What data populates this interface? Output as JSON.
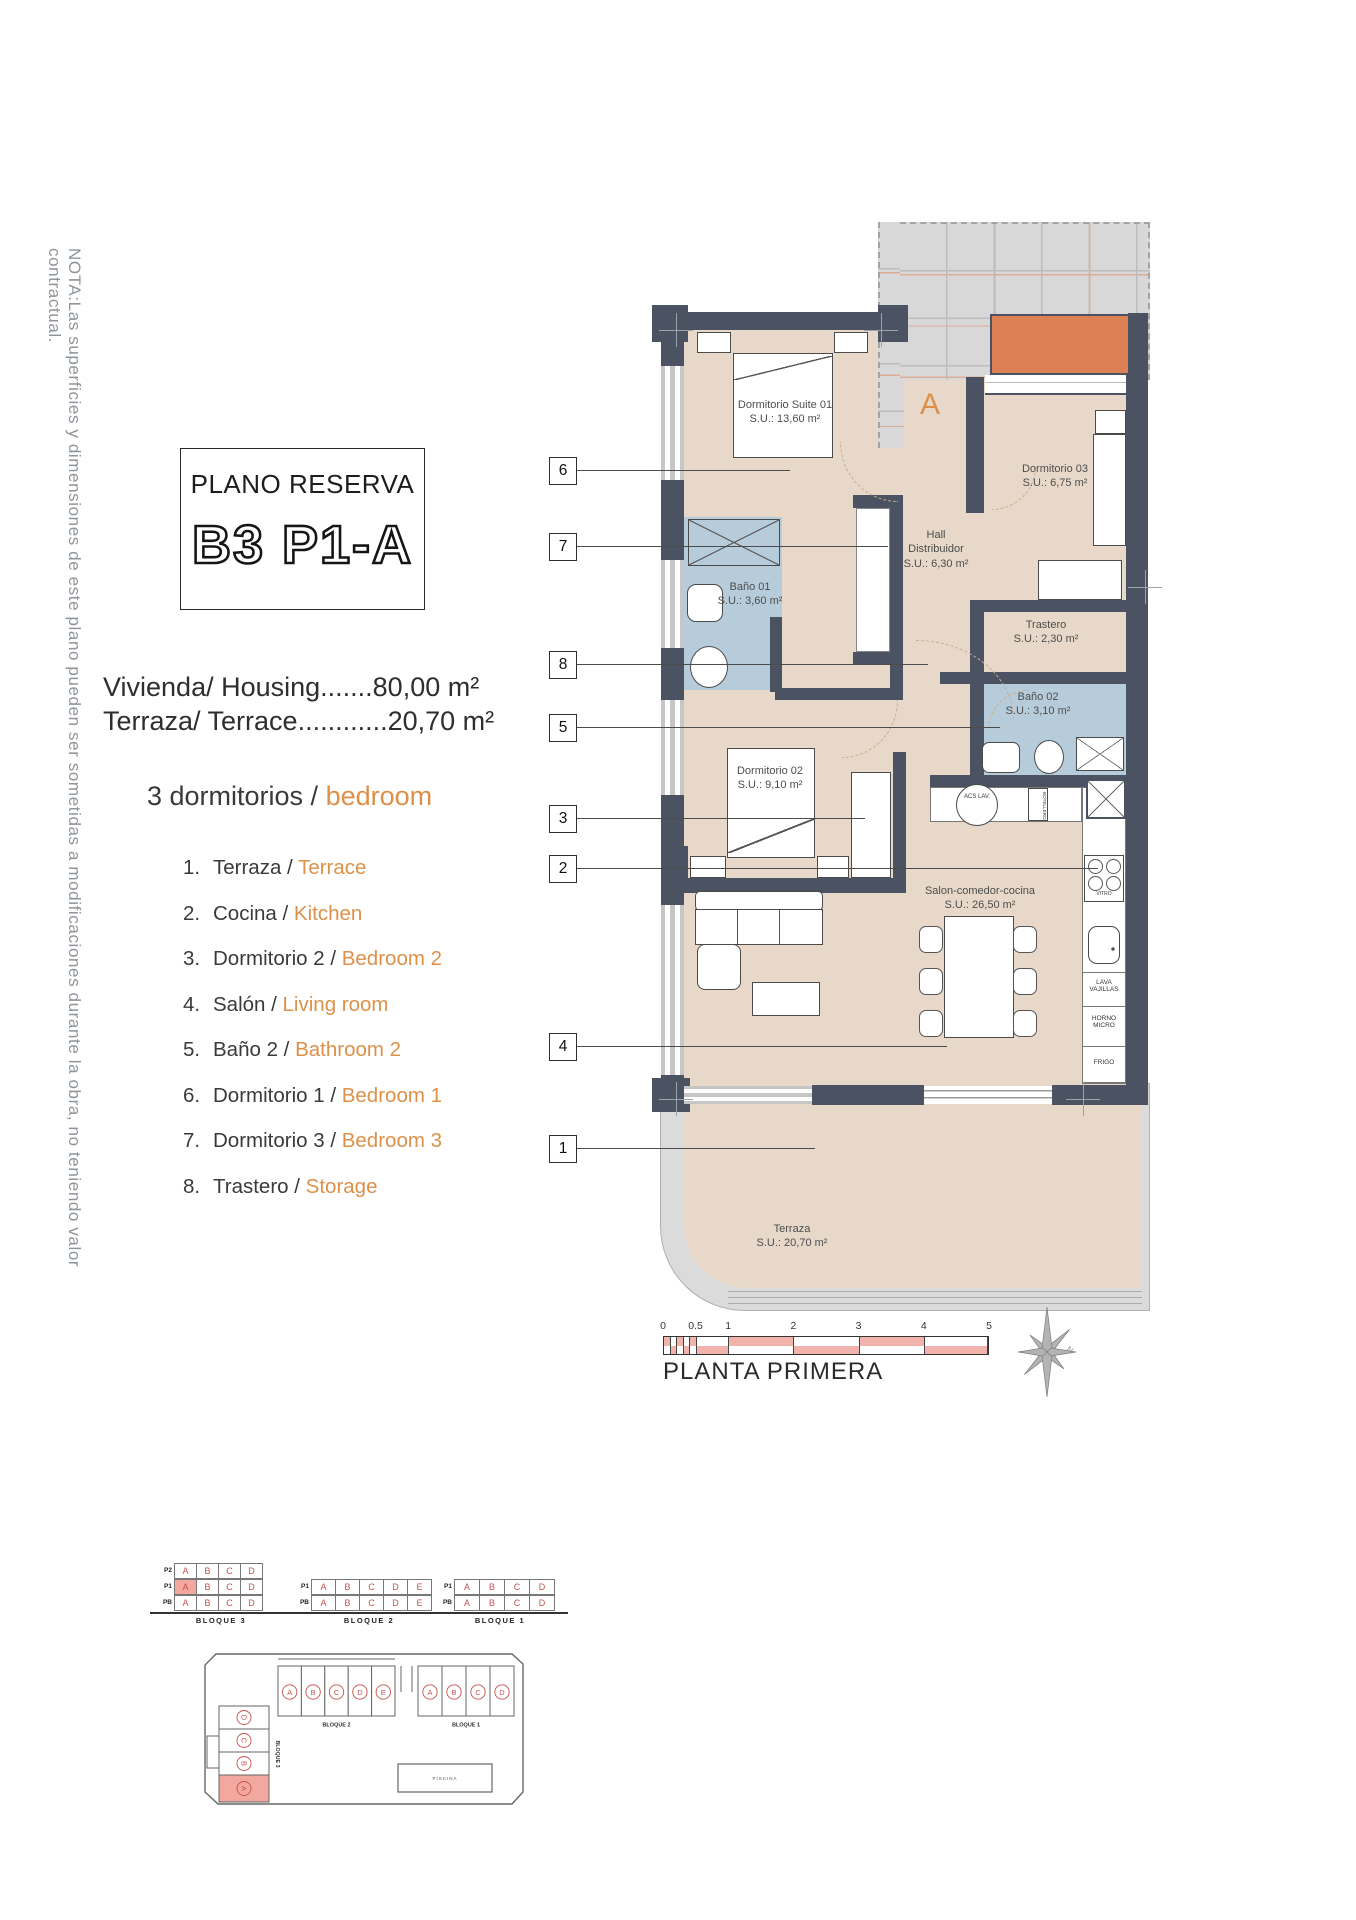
{
  "note": "NOTA:Las superficies y dimensiones de este plano pueden ser sometidas a modificaciones durante la obra, no teniendo valor contractual.",
  "title_box": {
    "kicker": "PLANO RESERVA",
    "code": "B3 P1-A"
  },
  "summary": {
    "housing": "Vivienda/ Housing.......80,00 m²",
    "terrace": "Terraza/ Terrace............20,70 m²",
    "bedrooms_es": "3 dormitorios /",
    "bedrooms_en": "bedroom"
  },
  "legend": [
    {
      "num": "1.",
      "es": "Terraza /",
      "en": "Terrace"
    },
    {
      "num": "2.",
      "es": "Cocina /",
      "en": "Kitchen"
    },
    {
      "num": "3.",
      "es": "Dormitorio 2 /",
      "en": "Bedroom 2"
    },
    {
      "num": "4.",
      "es": "Salón /",
      "en": "Living room"
    },
    {
      "num": "5.",
      "es": "Baño 2 /",
      "en": "Bathroom 2"
    },
    {
      "num": "6.",
      "es": "Dormitorio 1 /",
      "en": "Bedroom 1"
    },
    {
      "num": "7.",
      "es": "Dormitorio 3 /",
      "en": "Bedroom 3"
    },
    {
      "num": "8.",
      "es": "Trastero /",
      "en": "Storage"
    }
  ],
  "plan": {
    "unit_letter": "A",
    "rooms": {
      "suite": {
        "name": "Dormitorio Suite 01",
        "area": "S.U.: 13,60 m²"
      },
      "dorm03": {
        "name": "Dormitorio 03",
        "area": "S.U.: 6,75 m²"
      },
      "hall": {
        "name": "Hall Distribuidor",
        "area": "S.U.: 6,30 m²"
      },
      "bano01": {
        "name": "Baño 01",
        "area": "S.U.: 3,60 m²"
      },
      "trastero": {
        "name": "Trastero",
        "area": "S.U.: 2,30 m²"
      },
      "bano02": {
        "name": "Baño 02",
        "area": "S.U.: 3,10 m²"
      },
      "dorm02": {
        "name": "Dormitorio 02",
        "area": "S.U.: 9,10 m²"
      },
      "salon": {
        "name": "Salon-comedor-cocina",
        "area": "S.U.: 26,50 m²"
      },
      "terraza": {
        "name": "Terraza",
        "area": "S.U.: 20,70 m²"
      }
    },
    "callouts": [
      "6",
      "7",
      "8",
      "5",
      "3",
      "2",
      "4",
      "1"
    ],
    "kitchen": {
      "acs": "ACS LAV.",
      "botellero": "BOTELLERO",
      "vitro": "VITRO",
      "lavavajillas": "LAVA VAJILLAS",
      "horno": "HORNO MICRO",
      "frigo": "FRIGO"
    }
  },
  "scalebar": {
    "ticks": [
      "0",
      "0.5",
      "1",
      "2",
      "3",
      "4",
      "5"
    ],
    "caption": "PLANTA PRIMERA"
  },
  "blocks": {
    "b3": {
      "label": "BLOQUE 3",
      "floors": [
        "P2",
        "P1",
        "PB"
      ],
      "rows": [
        [
          "A",
          "B",
          "C",
          "D"
        ],
        [
          "A",
          "B",
          "C",
          "D"
        ],
        [
          "A",
          "B",
          "C",
          "D"
        ]
      ]
    },
    "b2": {
      "label": "BLOQUE 2",
      "floors": [
        "P1",
        "PB"
      ],
      "rows": [
        [
          "A",
          "B",
          "C",
          "D",
          "E"
        ],
        [
          "A",
          "B",
          "C",
          "D",
          "E"
        ]
      ]
    },
    "b1": {
      "label": "BLOQUE 1",
      "floors": [
        "P1",
        "PB"
      ],
      "rows": [
        [
          "A",
          "B",
          "C",
          "D"
        ],
        [
          "A",
          "B",
          "C",
          "D"
        ]
      ]
    }
  },
  "siteplan": {
    "b3_label": "BLOQUE 3",
    "b3_units": [
      "D",
      "C",
      "B",
      "A"
    ],
    "b2_label": "BLOQUE 2",
    "b2_units": [
      "A",
      "B",
      "C",
      "D",
      "E"
    ],
    "b1_label": "BLOQUE 1",
    "b1_units": [
      "A",
      "B",
      "C",
      "D"
    ],
    "piscina": "PISCINA"
  },
  "colors": {
    "accent_orange": "#DD9048",
    "wall": "#4B5363",
    "floor_beige": "#E7D8C9",
    "bath_blue": "#B7CCDB",
    "neighbor_gray": "#D8D8D8",
    "planter_orange": "#DD8155",
    "scale_pink": "#F1B3AC",
    "unit_red": "#C4524E",
    "highlight_pink": "#F2A79F"
  }
}
